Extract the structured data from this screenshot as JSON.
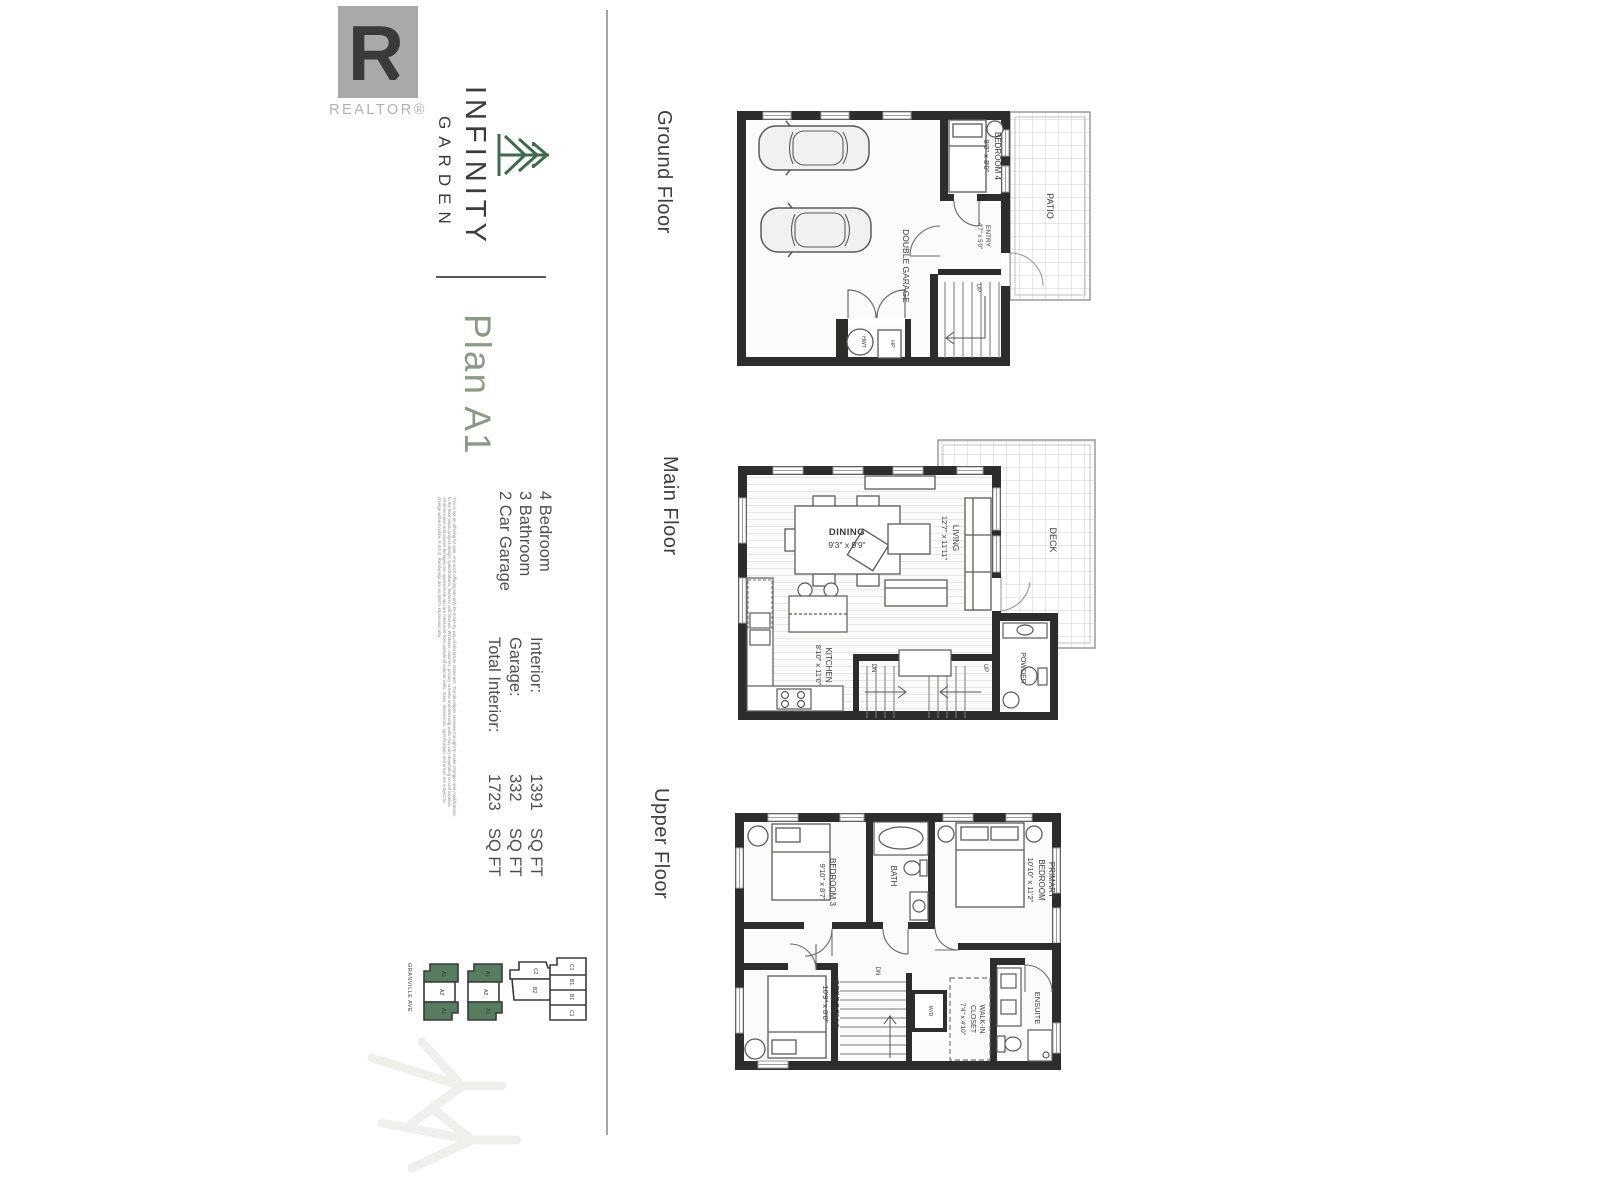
{
  "brand": {
    "logo_letter": "R",
    "realtor_label": "REALTOR®",
    "name_line1": "INFINITY",
    "name_line2": "GARDEN",
    "tree_icon": "pine-tree-icon",
    "green": "#3e6b4e",
    "logo_gray": "#a9a9a9"
  },
  "plan": {
    "title": "Plan A1",
    "title_color": "#8a9a84",
    "features": [
      "4 Bedroom",
      "3 Bathroom",
      "2 Car Garage"
    ],
    "areas": [
      {
        "label": "Interior:",
        "value": "1391",
        "unit": "SQ FT"
      },
      {
        "label": "Garage:",
        "value": "332",
        "unit": "SQ FT"
      },
      {
        "label": "Total Interior:",
        "value": "1723",
        "unit": "SQ FT"
      }
    ],
    "disclaimer_lines": [
      "This is not an offering for sale. Any such offering can only be made by way of disclosure statement. The developer reserves the right to make changes and modifications",
      "to the floor plans, project design, specifications, features and finishes. Windows, columns, privacy screens and demising walls may vary depending on unit location.",
      "All dimensions and square footages are approximate and are measured from outside of exterior walls. Sizes, dimensions, specifications and prices are subject to",
      "change without notice. E.&O.E. Renderings are an artist's impression only."
    ]
  },
  "floors": [
    {
      "label": "Ground Floor",
      "rooms": [
        {
          "name": "DOUBLE GARAGE"
        },
        {
          "name": "BEDROOM 4",
          "dims": "8'0\" x 8'0\""
        },
        {
          "name": "ENTRY",
          "dims": "4'7\" x 5'0\""
        },
        {
          "name": "PATIO"
        }
      ],
      "annotations": [
        "UP",
        "HWT",
        "HP"
      ]
    },
    {
      "label": "Main Floor",
      "rooms": [
        {
          "name": "DINING",
          "dims": "9'3\" x 9'9\""
        },
        {
          "name": "LIVING",
          "dims": "12'7\" x 11'11\""
        },
        {
          "name": "KITCHEN",
          "dims": "8'10\" x 11'0\""
        },
        {
          "name": "DECK"
        },
        {
          "name": "POWDER"
        }
      ],
      "annotations": [
        "DN",
        "UP"
      ]
    },
    {
      "label": "Upper Floor",
      "rooms": [
        {
          "name": "BEDROOM 3",
          "dims": "9'10\" x 8'7\""
        },
        {
          "name": "BATH"
        },
        {
          "name": "PRIMARY BEDROOM",
          "lines": [
            "PRIMARY",
            "BEDROOM"
          ],
          "dims": "10'10\" x 11'2\""
        },
        {
          "name": "BEDROOM 2",
          "dims": "10'9\" x 8'0\""
        },
        {
          "name": "WALK-IN CLOSET",
          "lines": [
            "WALK-IN",
            "CLOSET"
          ],
          "dims": "7'4\" x 4'10\""
        },
        {
          "name": "ENSUITE"
        }
      ],
      "annotations": [
        "DN",
        "W/D"
      ]
    }
  ],
  "site_plan": {
    "street": "GRANVILLE AVE",
    "unit_green": "#587c60",
    "buildings": [
      {
        "units": [
          {
            "label": "A1",
            "highlighted": true
          },
          {
            "label": "A2",
            "highlighted": false
          },
          {
            "label": "A1",
            "highlighted": true
          }
        ]
      },
      {
        "units": [
          {
            "label": "A1",
            "highlighted": true
          },
          {
            "label": "A2",
            "highlighted": false
          },
          {
            "label": "A1",
            "highlighted": true
          }
        ]
      },
      {
        "units": [
          {
            "label": "C2",
            "highlighted": false
          },
          {
            "label": "B2",
            "highlighted": false
          }
        ]
      },
      {
        "units": [
          {
            "label": "C1",
            "highlighted": false
          },
          {
            "label": "B1",
            "highlighted": false
          },
          {
            "label": "B1",
            "highlighted": false
          },
          {
            "label": "C1",
            "highlighted": false
          }
        ]
      }
    ]
  }
}
